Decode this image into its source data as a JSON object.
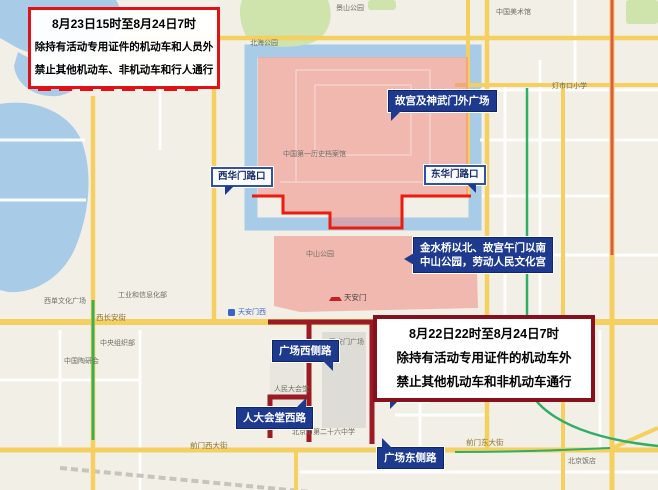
{
  "notice_boxes": {
    "box_a": {
      "lines": [
        "8月23日15时至8月24日7时",
        "除持有活动专用证件的机动车和人员外",
        "禁止其他机动车、非机动车和行人通行"
      ],
      "border_color": "#e01218"
    },
    "box_b": {
      "lines": [
        "8月22日22时至8月24日7时",
        "除持有活动专用证件的机动车外",
        "禁止其他机动车和非机动车通行"
      ],
      "border_color": "#87101f"
    }
  },
  "callouts": {
    "gugong_square": "故宫及神武门外广场",
    "xihuamen_crossing": "西华门路口",
    "donghuamen_crossing": "东华门路口",
    "jinshui_line1": "金水桥以北、故宫午门以南",
    "jinshui_line2": "中山公园，劳动人民文化宫",
    "square_west_road": "广场西侧路",
    "great_hall_west_road": "人大会堂西路",
    "xindalu_road": "新大路",
    "square_east_road": "广场东侧路"
  },
  "map": {
    "labels": [
      {
        "text": "北海公园"
      },
      {
        "text": "景山公园"
      },
      {
        "text": "中国美术馆"
      },
      {
        "text": "灯市口小学"
      },
      {
        "text": "西长安街"
      },
      {
        "text": "天安门西"
      },
      {
        "text": "中山公园"
      },
      {
        "text": "天安门"
      },
      {
        "text": "天安门广场"
      },
      {
        "text": "人民大会堂"
      },
      {
        "text": "中国第一历史档案馆"
      },
      {
        "text": "前门西大街"
      },
      {
        "text": "前门东大街"
      },
      {
        "text": "北京饭店"
      },
      {
        "text": "北京市第二十六中学"
      },
      {
        "text": "中国陶研会"
      },
      {
        "text": "中央组织部"
      },
      {
        "text": "西单文化广场"
      },
      {
        "text": "工业和信息化部"
      }
    ]
  },
  "colors": {
    "restricted_zone_fill": "#f18a84",
    "zone_boundary_red": "#ea1b0f",
    "closed_road_maroon": "#9a1b23",
    "callout_navy": "#1e3a8f",
    "water_blue": "#a8cbe8",
    "park_green": "#cfe3ad",
    "major_road_yellow": "#f5cf60"
  }
}
